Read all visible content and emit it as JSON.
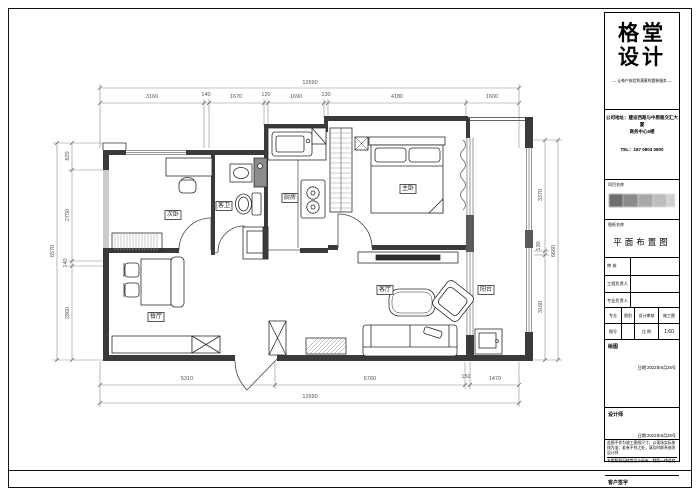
{
  "plan": {
    "room_labels": {
      "secondary_bedroom": "次卧",
      "bathroom": "客卫",
      "kitchen": "厨房",
      "master_bedroom": "主卧",
      "dining": "餐厅",
      "living": "客厅",
      "balcony": "阳台"
    },
    "dims": {
      "top_total": "12690",
      "top": [
        "3160",
        "140",
        "1670",
        "120",
        "1690",
        "130",
        "4180",
        "1600"
      ],
      "left_total": "6570",
      "left": [
        "820",
        "2750",
        "140",
        "2860"
      ],
      "right": [
        "3370",
        "130",
        "3160"
      ],
      "right_total": "6660",
      "bottom": [
        "5310",
        "5760",
        "150",
        "1470"
      ],
      "bottom_total": "12690"
    }
  },
  "title_block": {
    "logo_top": "格堂",
    "logo_bottom": "设计",
    "tagline": "— 让每户体验到满意的整装服务 —",
    "address1": "公司地址：建设西路与中原路交汇大厦",
    "address2": "商务中心5楼",
    "phone": "TEL：187 0804 0800",
    "project_label": "项目名称",
    "drawing_label": "图纸名称",
    "drawing_title": "平面布置图",
    "row_review": "审 核",
    "row_pm": "工程负责人",
    "row_lead": "专业负责人",
    "grid": {
      "major": "专业",
      "type": "图别",
      "check": "设计审核",
      "stage": "施工图",
      "no_label": "图号",
      "no_value": "",
      "scale_label": "比 例",
      "scale_value": "1:60"
    },
    "draw_label": "绘图",
    "draw_date": "日期:2022年6月25号",
    "designer_label": "设计师",
    "designer_date": "日期:2022年6月25号",
    "client_label": "客户签字",
    "client_date": "日期:2022年6月25号",
    "note1": "此图不作为竣工图纸尺寸，以现场实际放线为准；若有不符之处，请及时联系修改设计师",
    "note2": "本图版权归格堂设计所有，翻版一律追究"
  }
}
